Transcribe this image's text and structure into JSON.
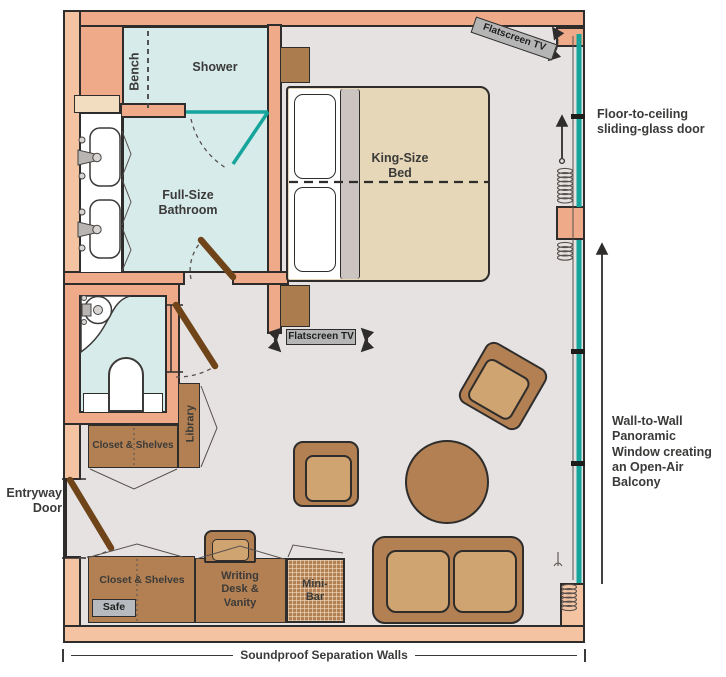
{
  "title": "Suite floor plan",
  "colors": {
    "wall": "#efab89",
    "wall_outer": "#f4c3a2",
    "outline": "#2e2d2c",
    "floor": "#e5e2e1",
    "wet_room": "#d6ebea",
    "glass": "#16a59c",
    "furniture": "#b28052",
    "furniture_light": "#cfa470",
    "bed": "#e6d7b8",
    "door": "#6f4418",
    "label_gray": "#b5b5b5",
    "cream": "#f3ddc0"
  },
  "rooms": {
    "bench": "Bench",
    "shower": "Shower",
    "bathroom": "Full-Size Bathroom",
    "king_bed": "King-Size Bed",
    "library": "Library",
    "closet_mid": "Closet & Shelves",
    "closet_bottom": "Closet & Shelves",
    "safe": "Safe",
    "writing_desk": "Writing Desk & Vanity",
    "mini_bar": "Mini-Bar"
  },
  "labels": {
    "tv_bedroom": "Flatscreen TV",
    "tv_living": "Flatscreen TV",
    "sliding_door": "Floor-to-ceiling sliding-glass door",
    "panoramic_window": "Wall-to-Wall Panoramic Window creating an Open-Air Balcony",
    "entry_door": "Entryway Door",
    "soundproof": "Soundproof Separation Walls"
  }
}
